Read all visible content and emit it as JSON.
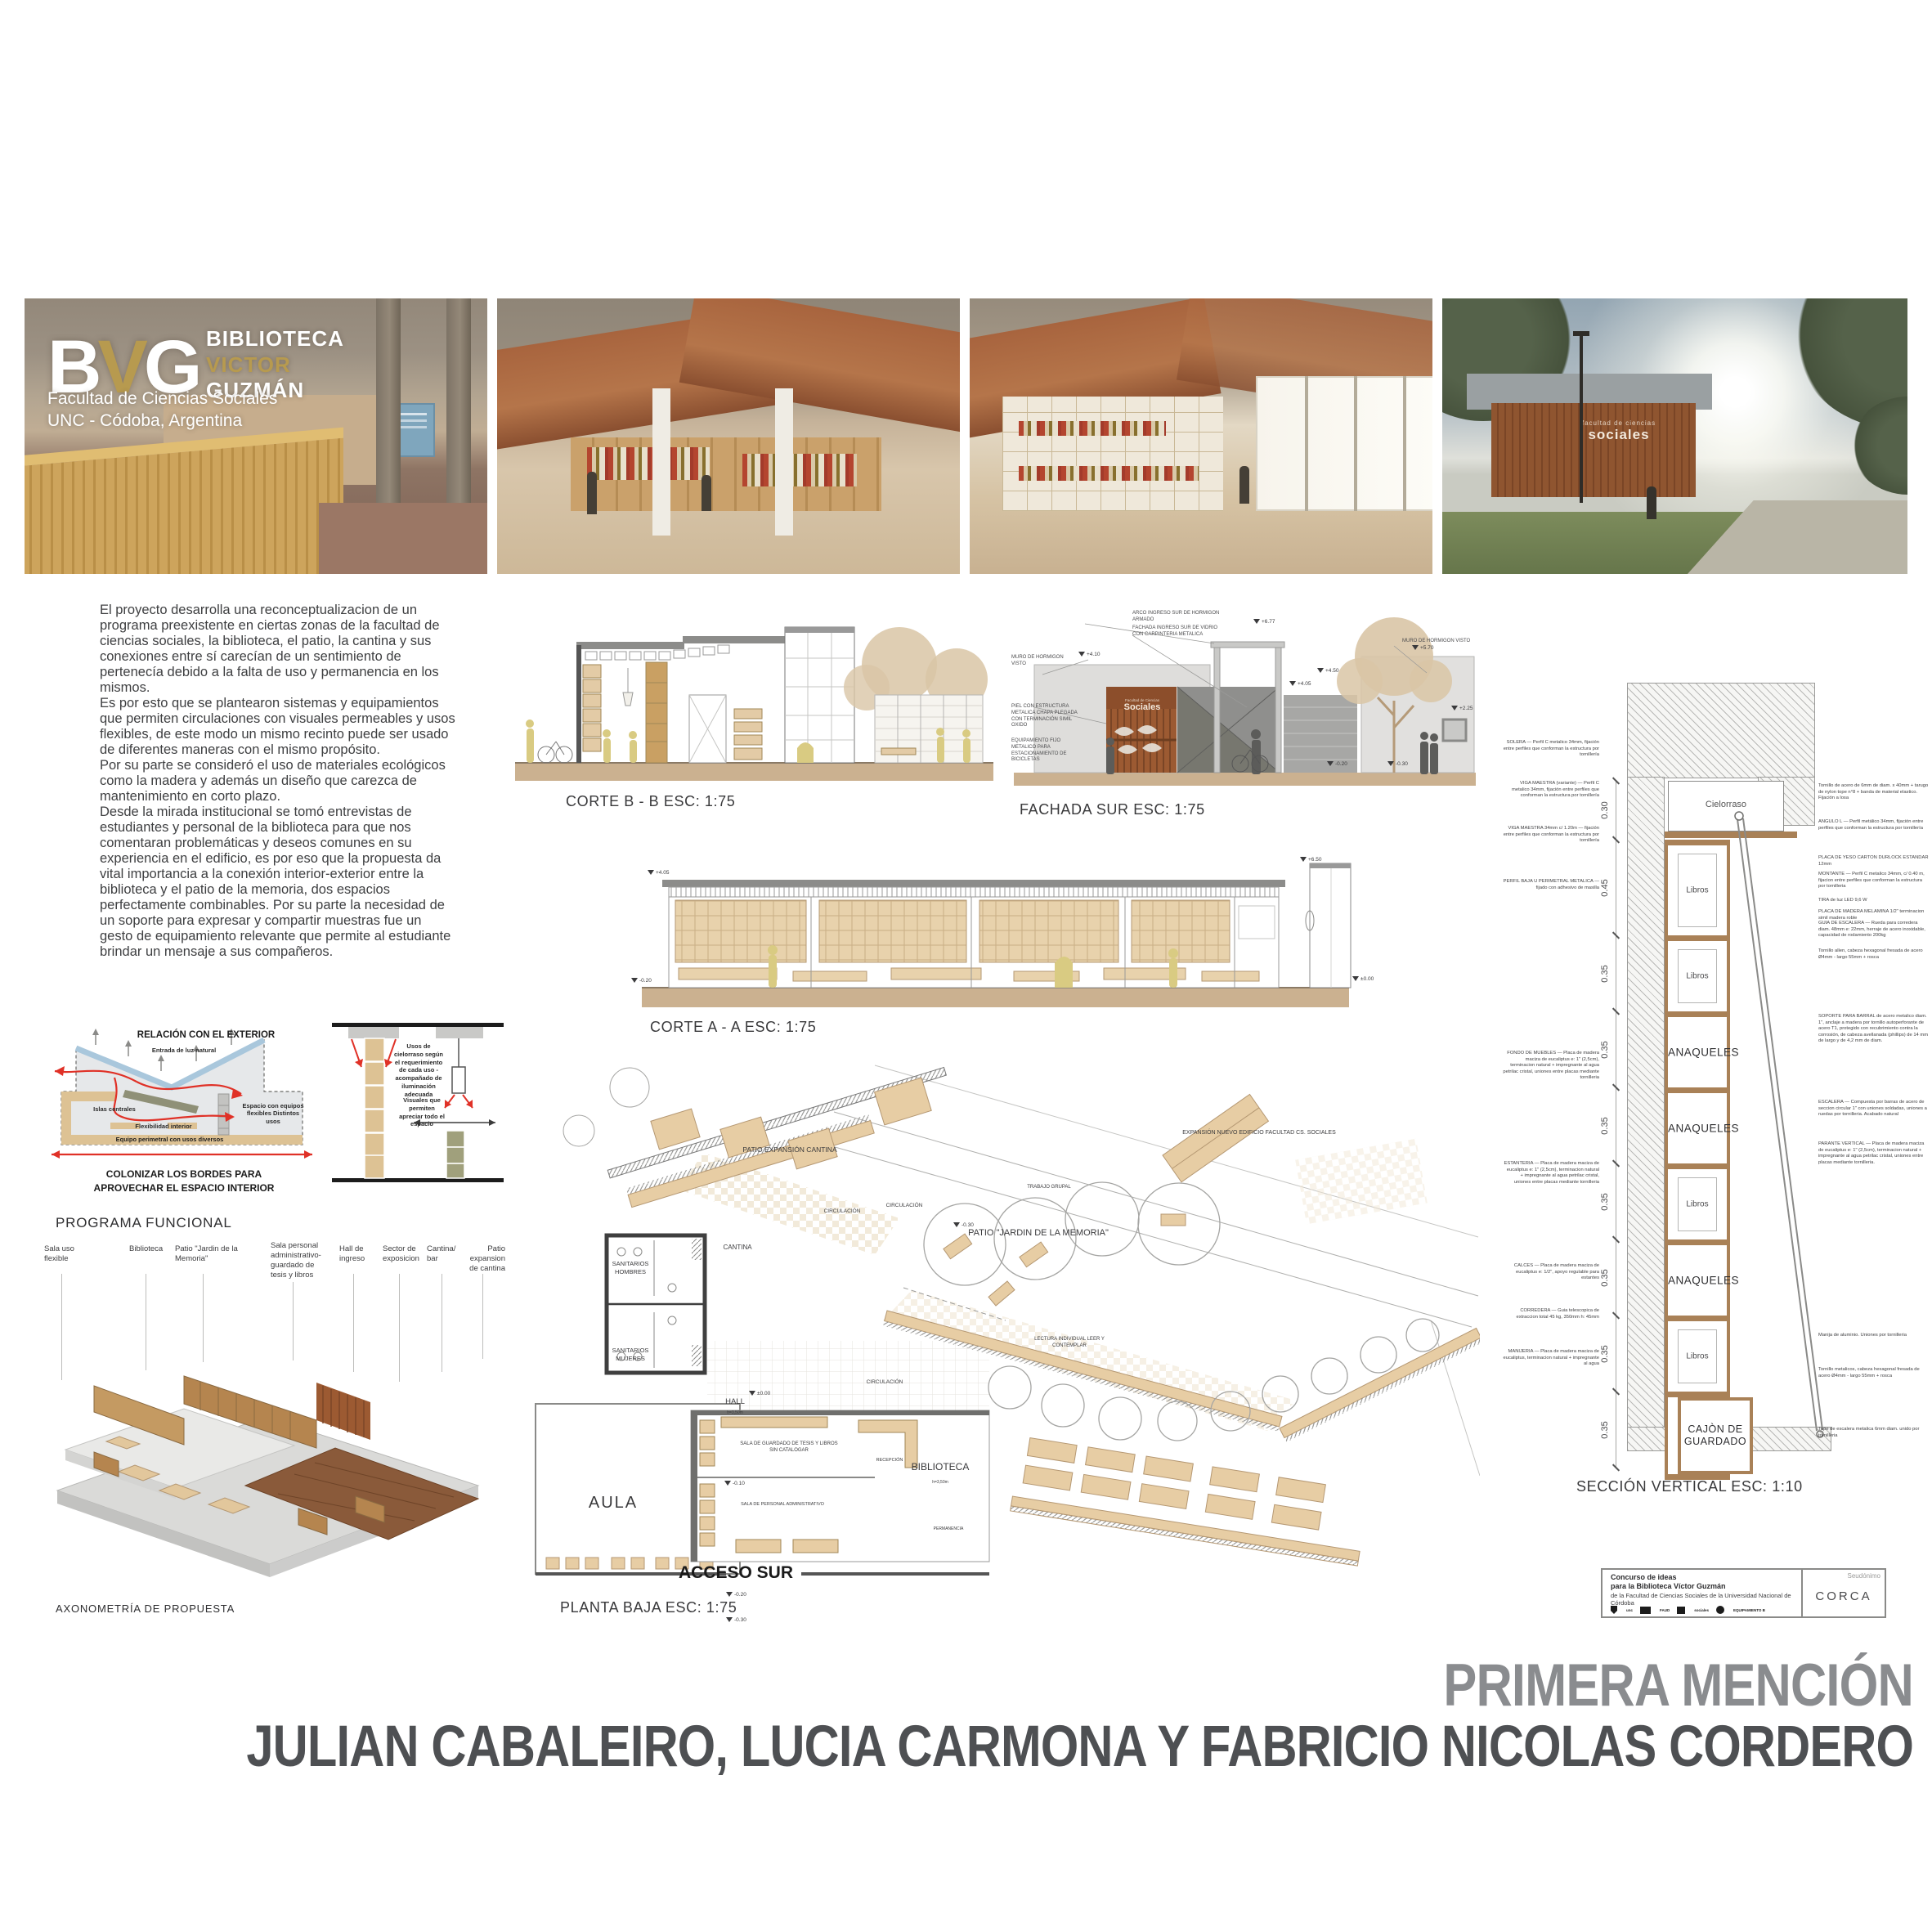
{
  "colors": {
    "accent_gold": "#b79a4f",
    "corten": "#9c5a32",
    "plan_tan": "#e7cda4",
    "red_arrow": "#e03127",
    "diagram_blue": "#a9c7dc",
    "award_gray": "#8a8c8f",
    "authors_gray": "#4e5053"
  },
  "logo": {
    "b": "B",
    "v": "V",
    "g": "G",
    "line1": "BIBLIOTECA",
    "line2": "VICTOR",
    "line3": "GUZMÁN",
    "sub1": "Facultad de Ciencias Sociales",
    "sub2": "UNC - Códoba, Argentina"
  },
  "exterior_sign": {
    "line1": "facultad de ciencias",
    "line2": "sociales"
  },
  "intro": {
    "paragraphs": [
      "El proyecto desarrolla una reconceptualizacion de un programa preexistente en ciertas zonas de la facultad de ciencias sociales, la biblioteca, el patio, la cantina y sus conexiones entre sí carecían de un sentimiento de pertenecía debido a la falta de uso y permanencia en los mismos.",
      "Es por esto que se plantearon sistemas y equipamientos que permiten circulaciones con visuales permeables y usos flexibles, de este modo un mismo recinto puede ser usado de diferentes maneras con el mismo propósito.",
      "Por su parte se consideró el uso de materiales ecológicos como la madera y además un diseño que carezca de mantenimiento en corto plazo.",
      "Desde la mirada institucional se tomó entrevistas de estudiantes y personal de la biblioteca para que nos comentaran problemáticas y deseos comunes en su experiencia en el edificio, es por eso que la propuesta da vital importancia a la conexión interior-exterior entre la biblioteca y el patio de la memoria, dos espacios perfectamente combinables. Por su parte la necesidad de un soporte para expresar y compartir muestras fue un gesto de equipamiento relevante que permite al estudiante brindar un mensaje a sus compañeros."
    ]
  },
  "diagram_exterior": {
    "title": "RELACIÓN CON EL EXTERIOR",
    "entrada": "Entrada de luz natural",
    "islas": "Islas centrales",
    "flexibilidad": "Flexibilidad interior",
    "espacio": "Espacio con equipos flexibles Distintos usos",
    "perimetral": "Equipo perimetral con usos diversos",
    "caption": "COLONIZAR LOS BORDES PARA APROVECHAR EL ESPACIO INTERIOR"
  },
  "diagram_ceiling": {
    "usos": "Usos de cielorraso según el requerimiento de cada uso - acompañado de iluminación adecuada",
    "visuales": "Visuales que permiten apreciar todo el espacio"
  },
  "programa": {
    "title": "PROGRAMA FUNCIONAL",
    "items": [
      "Sala uso flexible",
      "Biblioteca",
      "Patio \"Jardin de la Memoria\"",
      "Sala personal administrativo- guardado de tesis y libros",
      "Hall de ingreso",
      "Sector de exposicion",
      "Cantina/ bar",
      "Patio expansion de cantina"
    ],
    "axo_caption": "AXONOMETRÍA DE PROPUESTA"
  },
  "drawings": {
    "corte_b": "CORTE B - B ESC: 1:75",
    "fachada_sur": "FACHADA SUR ESC: 1:75",
    "corte_a": "CORTE A - A ESC: 1:75",
    "planta_baja": "PLANTA BAJA ESC: 1:75",
    "seccion_vertical": "SECCIÓN VERTICAL ESC: 1:10"
  },
  "fachada": {
    "ann_muro": "MURO DE HORMIGON VISTO",
    "ann_piel": "PIEL CON ESTRUCTURA METALICA CHAPA PLEGADA CON TERMINACIÓN SIMIL OXIDO",
    "ann_equip": "EQUIPAMIENTO FIJO METALICO PARA ESTACIONAMIENTO DE BICICLETAS",
    "ann_arco": "ARCO INGRESO SUR DE HORMIGON ARMADO",
    "ann_vidrio": "FACHADA INGRESO SUR DE VIDRIO CON CARPINTERIA METALICA",
    "ann_muro_der": "MURO DE HORMIGON VISTO",
    "sign_top": "Facultad de Ciencias",
    "sign_main": "Sociales",
    "levels": {
      "a": "+6.77",
      "b": "+4.10",
      "c": "+5.70",
      "d": "+4.50",
      "e": "+4.05",
      "f": "+2.25",
      "g": "-0.20",
      "h": "-0.30"
    }
  },
  "corte_a_marks": {
    "l1": "+4.05",
    "l2": "-0.20",
    "l3": "+6.50",
    "l4": "±0.00"
  },
  "plan": {
    "labels": {
      "patio_cantina": "PATIO EXPANSIÓN CANTINA",
      "cantina": "CANTINA",
      "sanitarios_hombres": "SANITARIOS HOMBRES",
      "sanitarios_mujeres": "SANITARIOS MUJERES",
      "circulacion": "CIRCULACIÓN",
      "hall": "HALL",
      "hall_altura": "h=3,50m",
      "aula": "AULA",
      "acceso_sur": "ACCESO SUR",
      "biblioteca": "BIBLIOTECA",
      "biblioteca_altura": "h=3,50m",
      "patio_memoria": "PATIO \"JARDIN DE LA MEMORIA\"",
      "trabajo_grupal": "TRABAJO GRUPAL",
      "lectura_individual": "LECTURA INDIVIDUAL LEER Y CONTEMPLAR",
      "expansion": "EXPANSIÓN NUEVO EDIFICIO FACULTAD CS. SOCIALES",
      "sala_guardado": "SALA DE GUARDADO DE TESIS Y LIBROS SIN CATALOGAR",
      "recepcion": "RECEPCIÓN",
      "sala_personal": "SALA DE PERSONAL ADMINISTRATIVO",
      "permanencia": "PERMANENCIA"
    },
    "levels": {
      "menos010": "-0.10",
      "cero": "±0.00",
      "menos020": "-0.20",
      "menos030": "-0.30"
    }
  },
  "seccion": {
    "cielorraso": "Cielorraso",
    "dim_top": "0.30",
    "shelves": [
      {
        "label": "Libros",
        "dim": "0.45",
        "h": 110
      },
      {
        "label": "Libros",
        "dim": "0.35",
        "h": 86
      },
      {
        "label": "ANAQUELES",
        "dim": "0.35",
        "h": 86
      },
      {
        "label": "ANAQUELES",
        "dim": "0.35",
        "h": 86
      },
      {
        "label": "Libros",
        "dim": "0.35",
        "h": 86
      },
      {
        "label": "ANAQUELES",
        "dim": "0.35",
        "h": 86
      },
      {
        "label": "Libros",
        "dim": "0.35",
        "h": 86
      },
      {
        "label": "CAJÒN DE GUARDADO",
        "dim": "0.35",
        "h": 86,
        "drawer": true
      }
    ],
    "right_annotations": [
      "Tornillo de acero de 6mm de diam. x 40mm + tarugo de nylon tope n°8 + banda de material elastico. Fijación a losa",
      "ANGULO L — Perfil metálico 34mm, fijación entre perfiles que conforman la estructura por tornillería",
      "PLACA DE YESO CARTON DURLOCK ESTANDAR 12mm",
      "MONTANTE — Perfil C metalico 34mm, c/ 0.40 m, fijacion entre perfiles que conforman la estructura por tornilleria",
      "TIRA de luz LED 9,6 W",
      "PLACA DE MADERA MELAMINA 1/2\" terminacion simil madera roble",
      "GUIA DE ESCALERA — Rueda para corredera diam. 48mm e: 22mm, herraje de acero inoxidable, capacidad de rodamiento 200kg",
      "Tornillo allen, cabeza hexagonal fresada de acero Ø4mm - largo 55mm + rosca",
      "SOPORTE PARA BARRAL de acero metalico diam. 1\", anclaje a madera por tornillo autoperforante de acero T1, protegido con recubrimiento contra la corrosión, de cabeza avellanada (phillips) de 14 mm de largo y de 4,2 mm de diam.",
      "ESCALERA — Compuesta por barras de acero de seccion circular 1\" con uniones soldadas, uniones a ruedas por tornilleria. Acabado natural",
      "PARANTE VERTICAL — Placa de madera maciza de eucaliptus e: 1\" (2,5cm), terminacion natural + impregnante al agua petrilac cristal, uniones entre placas mediante tornilleria.",
      "Manija de aluminio. Uniones por tornilleria",
      "Tornillo metalicos, cabeza hexagonal fresada de acero Ø4mm - largo 55mm + rosca",
      "Tope de escalera metalica 6mm diam. unido por tornilleria"
    ],
    "left_annotations": [
      "SOLERA — Perfil C metalico 34mm, fijación entre perfiles que conforman la estructura por tornillería",
      "VIGA MAESTRA (variante) — Perfil C metalico 34mm, fijación entre perfiles que conforman la estructura por tornillería",
      "VIGA MAESTRA 34mm c/ 1.20m — fijación entre perfiles que conforman la estructura por tornillería",
      "PERFIL BAJA U PERIMETRAL METALICA — fijado con adhesivo de masilla",
      "FONDO DE MUEBLES — Placa de madera maciza de eucaliptus e: 1\" (2,5cm), terminacion natural + impregnante al agua petrilac cristal, uniones entre placas mediante tornilleria",
      "ESTANTERIA — Placa de madera maciza de eucaliptus e: 1\" (2,5cm), terminacion natural + impregnante al agua petrilac cristal, uniones entre placas mediante tornilleria",
      "CALCES — Placa de madera maciza de eucaliptus e: 1/2\", apoyo regulable para estantes",
      "CORREDERA — Guia telescopica de extraccion total 45 kg, 350mm h: 45mm",
      "MANIJERIA — Placa de madera maciza de eucaliptus, terminacion natural + impregnante al agua"
    ]
  },
  "titleblock": {
    "line1": "Concurso de ideas",
    "line2": "para la Biblioteca Víctor Guzmán",
    "line3": "de la Facultad de Ciencias Sociales de la Universidad Nacional de Córdoba",
    "seudonimo_label": "Seudónimo",
    "seudonimo": "CORCA",
    "logos": [
      "unc",
      "FAUD",
      "sociales",
      "EQUIPAMIENTO B"
    ]
  },
  "award": {
    "title": "PRIMERA MENCIÓN",
    "authors": "JULIAN CABALEIRO, LUCIA CARMONA Y FABRICIO NICOLAS CORDERO"
  }
}
